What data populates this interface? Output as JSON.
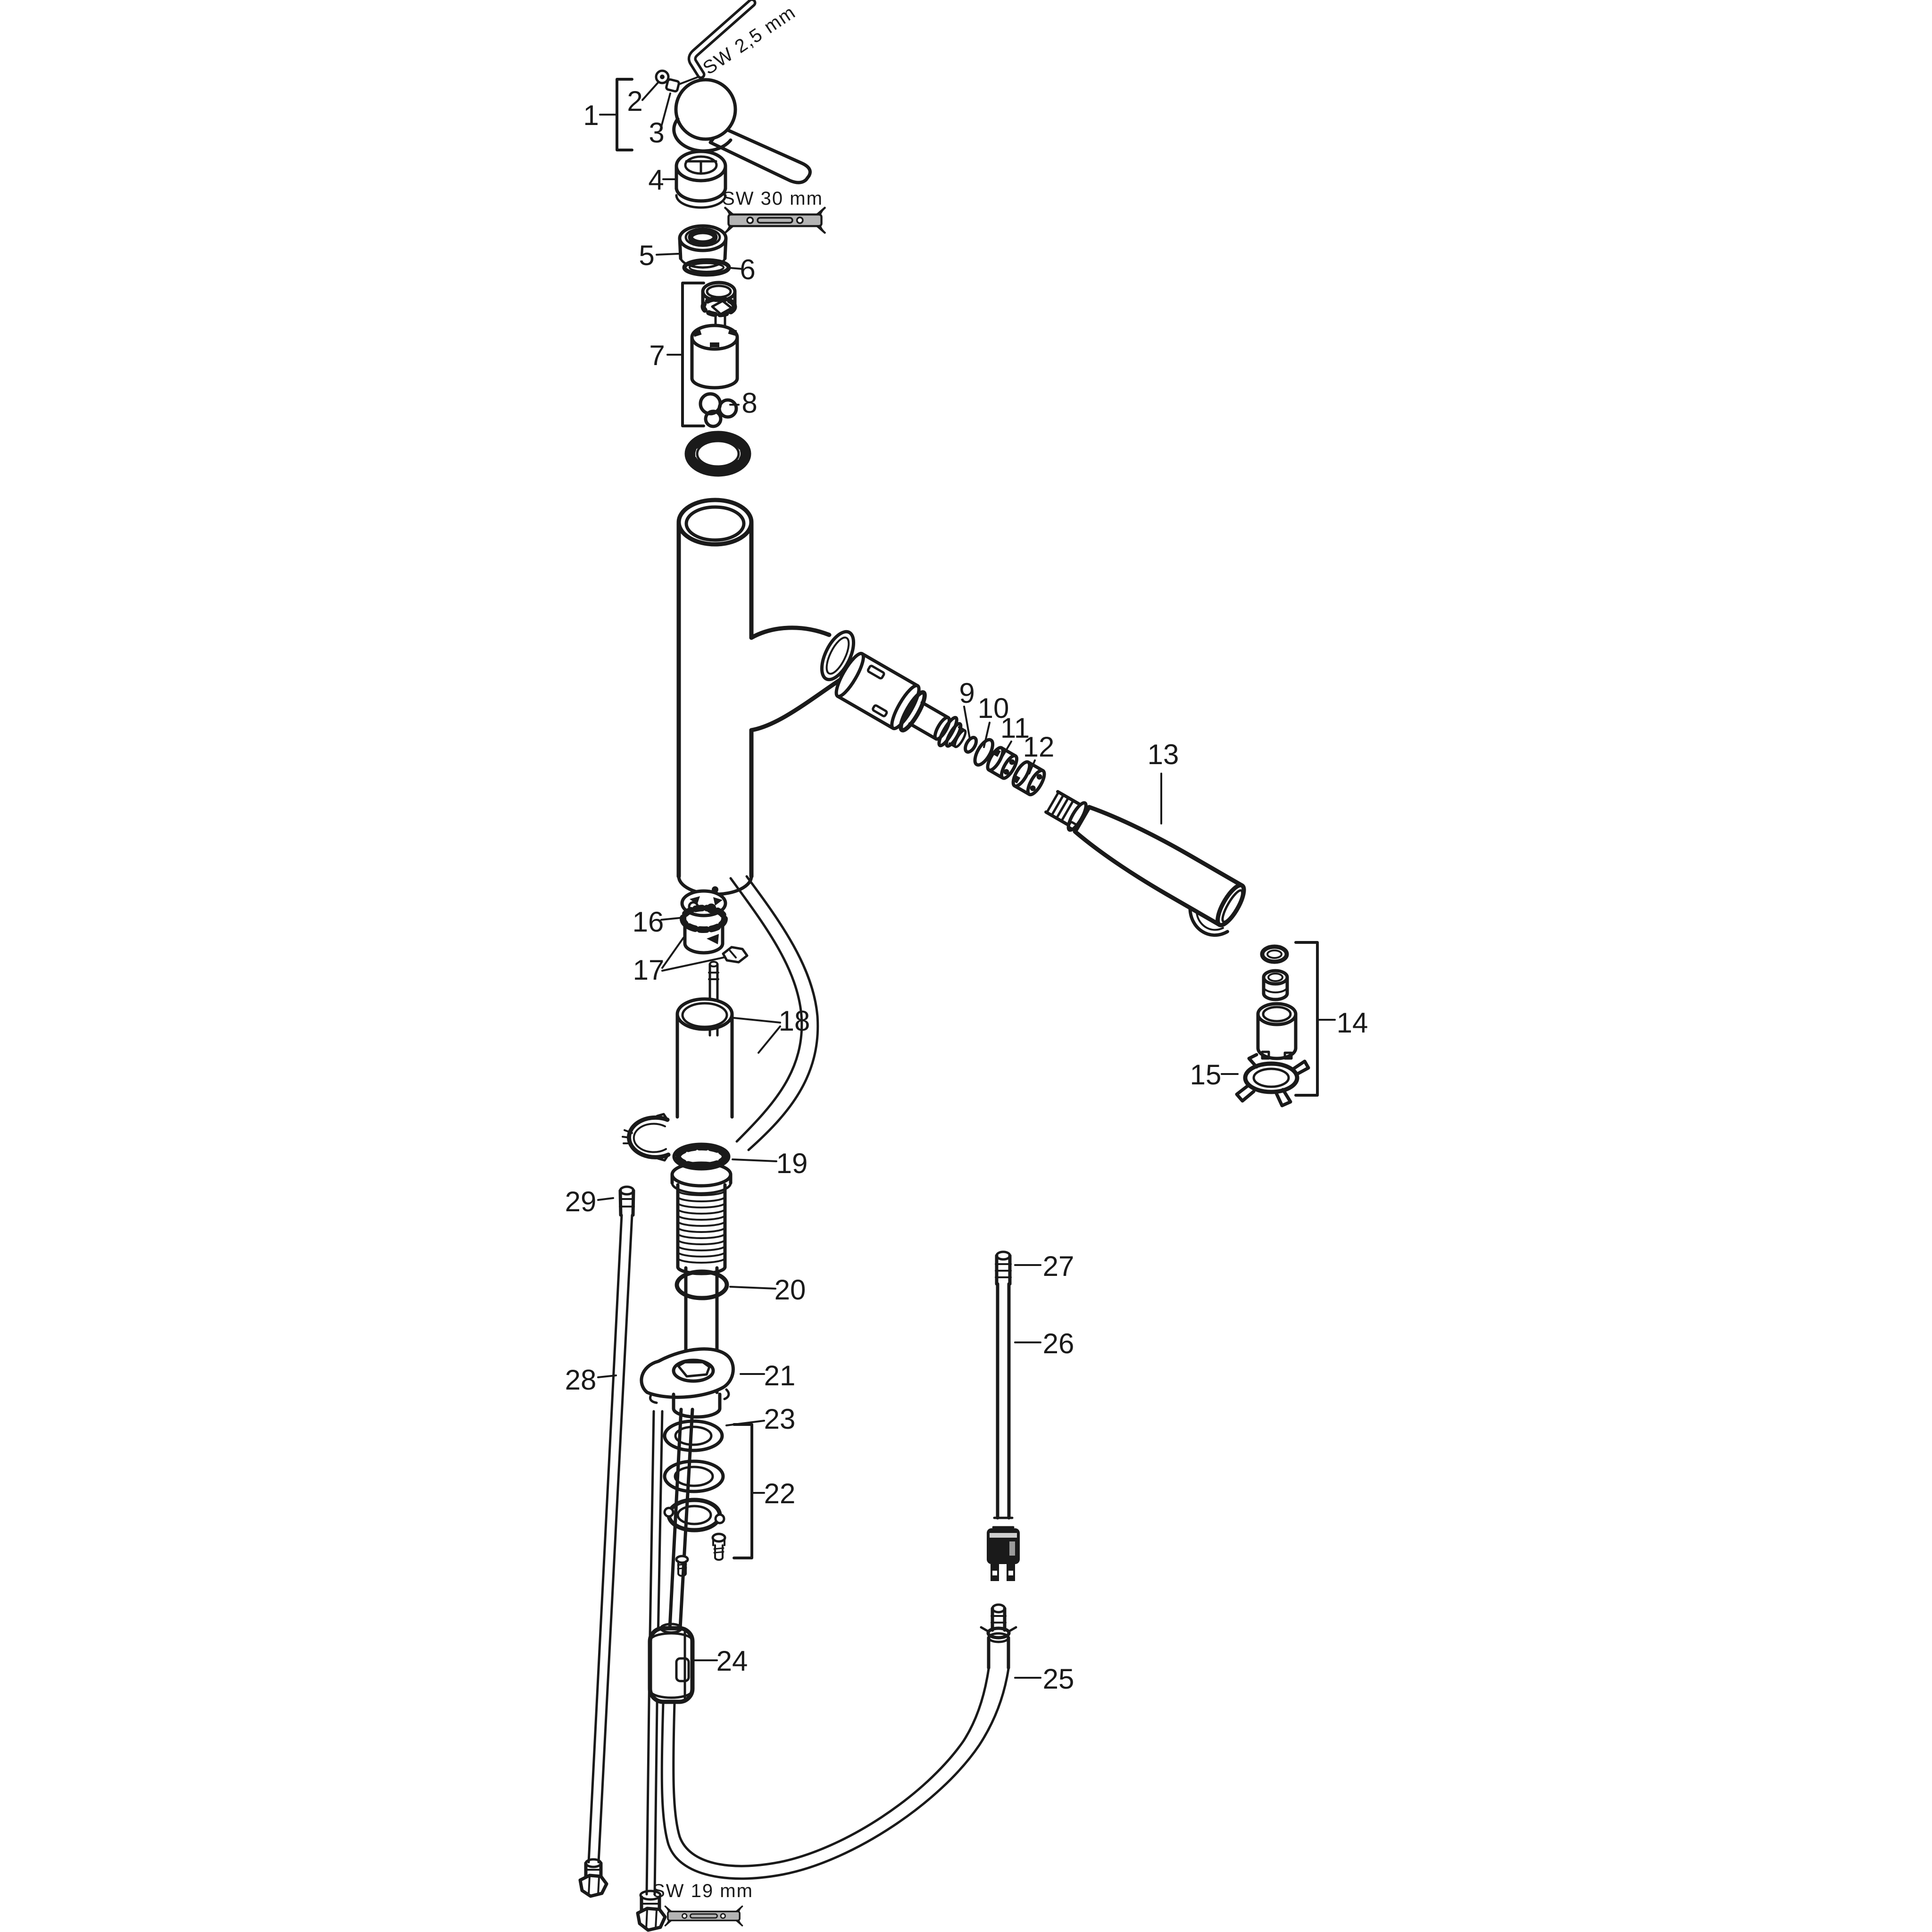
{
  "diagram": {
    "type": "exploded-parts-diagram",
    "subject": "single-lever kitchen mixer with pull-out spout",
    "colors": {
      "background": "#ffffff",
      "line": "#1a1a1a",
      "wrench_fill": "#b4b4b4"
    },
    "tool_labels": {
      "allen_key": "SW 2,5 mm",
      "wrench_top": "SW 30 mm",
      "wrench_bottom": "SW 19 mm"
    },
    "part_labels": {
      "p1": "1",
      "p2": "2",
      "p3": "3",
      "p4": "4",
      "p5": "5",
      "p6": "6",
      "p7": "7",
      "p8": "8",
      "p9": "9",
      "p10": "10",
      "p11": "11",
      "p12": "12",
      "p13": "13",
      "p14": "14",
      "p15": "15",
      "p16": "16",
      "p17": "17",
      "p18": "18",
      "p19": "19",
      "p20": "20",
      "p21": "21",
      "p22": "22",
      "p23": "23",
      "p24": "24",
      "p25": "25",
      "p26": "26",
      "p27": "27",
      "p28": "28",
      "p29": "29"
    }
  }
}
